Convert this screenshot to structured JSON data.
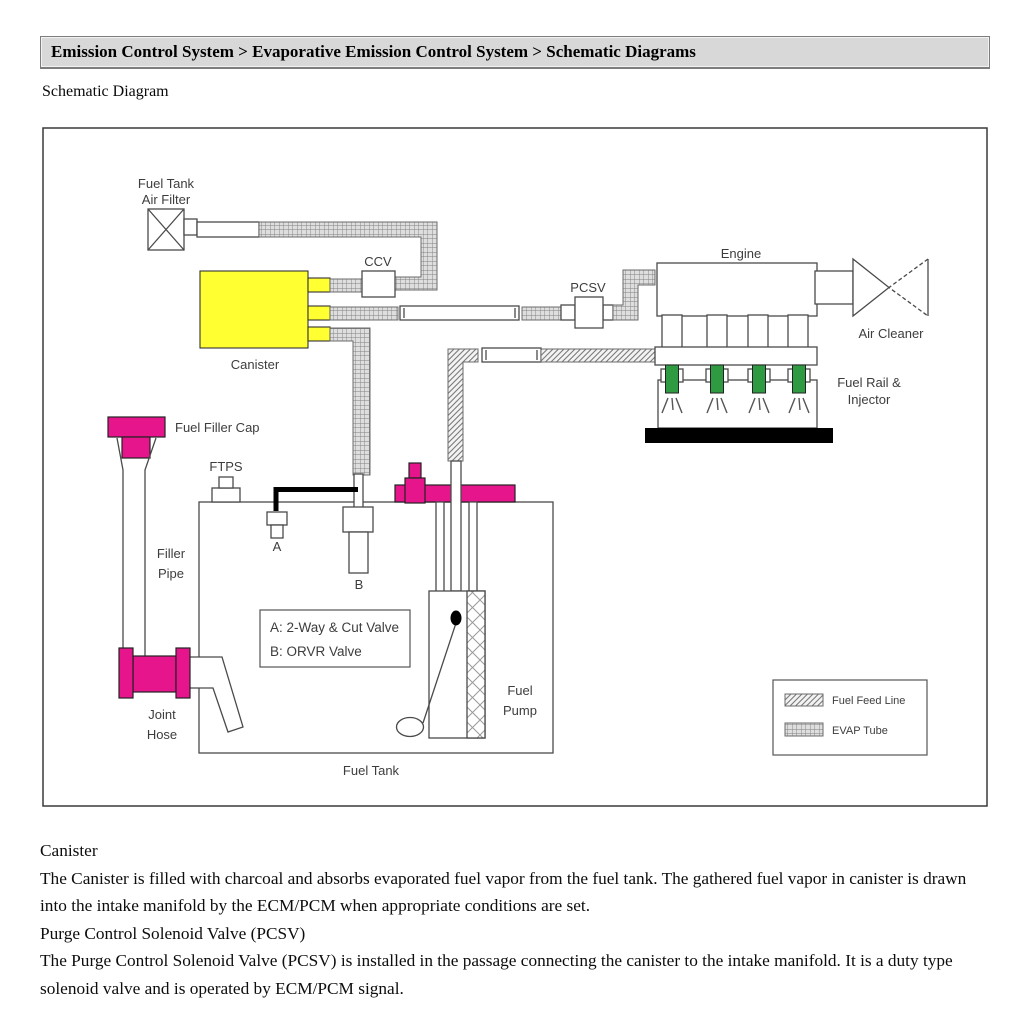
{
  "page": {
    "breadcrumb": "Emission Control System > Evaporative Emission Control System > Schematic Diagrams",
    "subtitle": "Schematic Diagram"
  },
  "diagram": {
    "labels": {
      "air_filter_1": "Fuel Tank",
      "air_filter_2": "Air Filter",
      "ccv": "CCV",
      "pcsv": "PCSV",
      "engine": "Engine",
      "air_cleaner": "Air Cleaner",
      "fuel_rail_1": "Fuel Rail &",
      "fuel_rail_2": "Injector",
      "canister": "Canister",
      "fuel_filler_cap": "Fuel Filler Cap",
      "ftps": "FTPS",
      "filler_pipe_1": "Filler",
      "filler_pipe_2": "Pipe",
      "valve_a": "A",
      "valve_b": "B",
      "valve_key_1": "A: 2-Way & Cut Valve",
      "valve_key_2": "B: ORVR Valve",
      "fuel_pump_1": "Fuel",
      "fuel_pump_2": "Pump",
      "fuel_tank": "Fuel Tank",
      "joint_hose_1": "Joint",
      "joint_hose_2": "Hose"
    },
    "legend": {
      "fuel_feed": "Fuel Feed Line",
      "evap": "EVAP Tube"
    },
    "colors": {
      "canister": "#ffff31",
      "magenta": "#e6158c",
      "injector": "#2e9b43"
    }
  },
  "body": {
    "sections": [
      {
        "heading": "Canister",
        "text": "The Canister is filled with charcoal and absorbs evaporated fuel vapor from the fuel tank. The gathered fuel vapor in canister is drawn into the intake manifold by the ECM/PCM when appropriate conditions are set."
      },
      {
        "heading": "Purge Control Solenoid Valve (PCSV)",
        "text": "The Purge Control Solenoid Valve (PCSV) is installed in the passage connecting the canister to the intake manifold. It is a duty type solenoid valve and is operated by ECM/PCM signal."
      }
    ]
  }
}
